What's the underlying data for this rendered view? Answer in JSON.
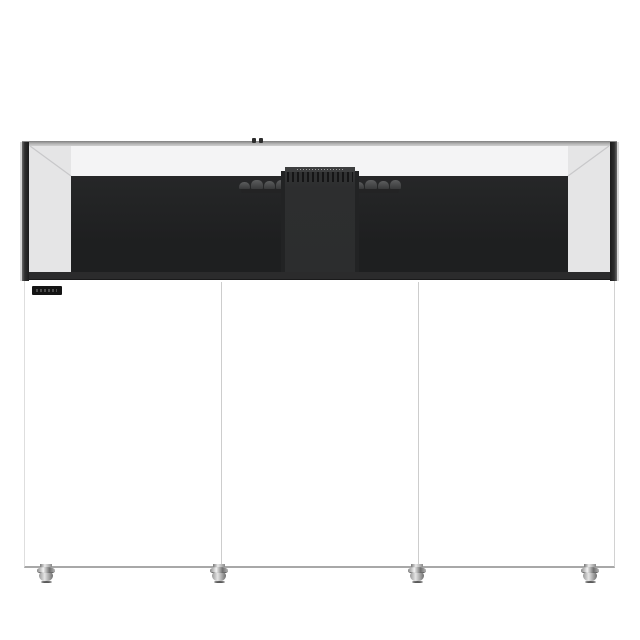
{
  "scene": {
    "subject": "rimless glass aquarium on white cabinet stand, front view on white background"
  },
  "tank": {
    "rim_color": "#9a9a9a",
    "glass_side_tint": "#e5e5e6",
    "glass_top_band_color": "#f4f4f5",
    "back_panel_color": "#1e1f20",
    "bottom_trim_color": "#2b2b2c",
    "overflow_box_color": "#2e2f30",
    "overflow_teeth_color": "#151516",
    "waterline_equipment_color": "#4b4c4d"
  },
  "cabinet": {
    "color": "#ffffff",
    "door_count": 3,
    "seam_color": "#cdcdcd",
    "badge_color": "#141414",
    "badge_text": ""
  },
  "feet": {
    "count": 4,
    "finish": "polished metal",
    "color": "#c0c0c0"
  }
}
